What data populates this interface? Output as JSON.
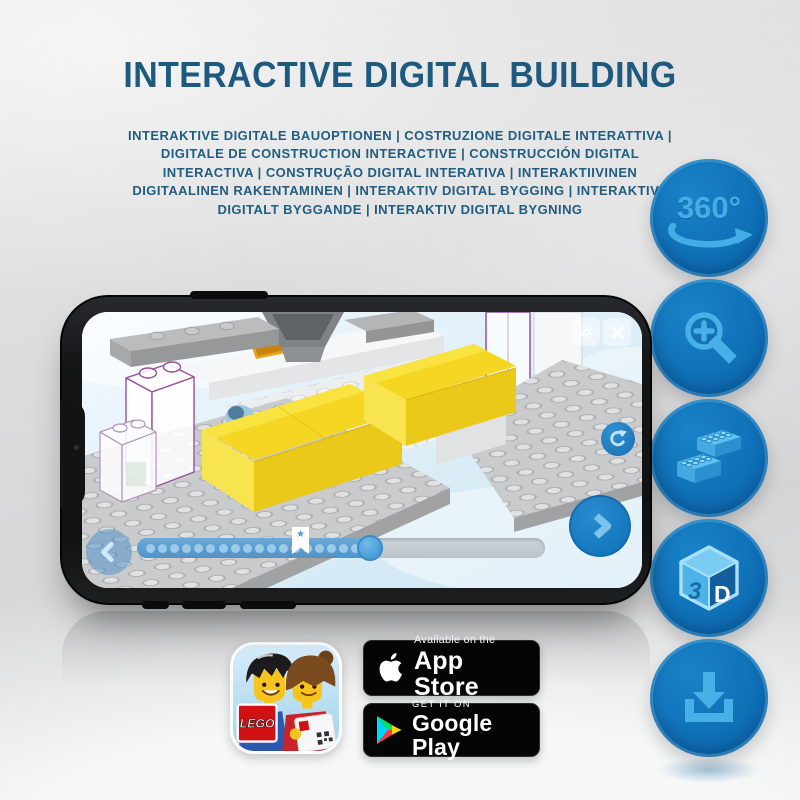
{
  "header": {
    "title": "INTERACTIVE DIGITAL BUILDING",
    "subtitle": "INTERAKTIVE DIGITALE BAUOPTIONEN | COSTRUZIONE DIGITALE INTERATTIVA | DIGITALE DE CONSTRUCTION INTERACTIVE | CONSTRUCCIÓN DIGITAL INTERACTIVA | CONSTRUÇÃO DIGITAL INTERATIVA | INTERAKTIIVINEN DIGITAALINEN RAKENTAMINEN | INTERAKTIV DIGITAL BYGGING | INTERAKTIVT DIGITALT BYGGANDE | INTERAKTIV DIGITAL BYGNING"
  },
  "feature_icons": [
    {
      "name": "360-rotation-icon",
      "label": "360°"
    },
    {
      "name": "zoom-in-icon"
    },
    {
      "name": "lego-bricks-icon"
    },
    {
      "name": "3d-view-icon",
      "letter_left": "3",
      "letter_right": "D"
    },
    {
      "name": "download-icon"
    }
  ],
  "phone": {
    "screen": {
      "toolbar_buttons": [
        "settings",
        "close"
      ],
      "rotate_button": "rotate-view",
      "nav_buttons": [
        "previous-step",
        "next-step"
      ],
      "progress": {
        "percent_complete": 57,
        "bookmark_percent": 38,
        "steps_shown": 18
      }
    }
  },
  "app_icon": {
    "description": "LEGO building-instructions app icon",
    "logo_text": "LEGO"
  },
  "badges": {
    "app_store": {
      "line1": "Available on the",
      "line2": "App Store"
    },
    "google_play": {
      "line1": "GET IT ON",
      "line2": "Google Play"
    }
  },
  "colors": {
    "title_blue": "#1e5a7e",
    "circle_blue": "#0d6cb2",
    "icon_light_blue": "#47b0e6",
    "brick_yellow": "#f5d723",
    "ghost_outline_purple": "#9a4fa0",
    "screen_sky": "#dff0f9"
  }
}
